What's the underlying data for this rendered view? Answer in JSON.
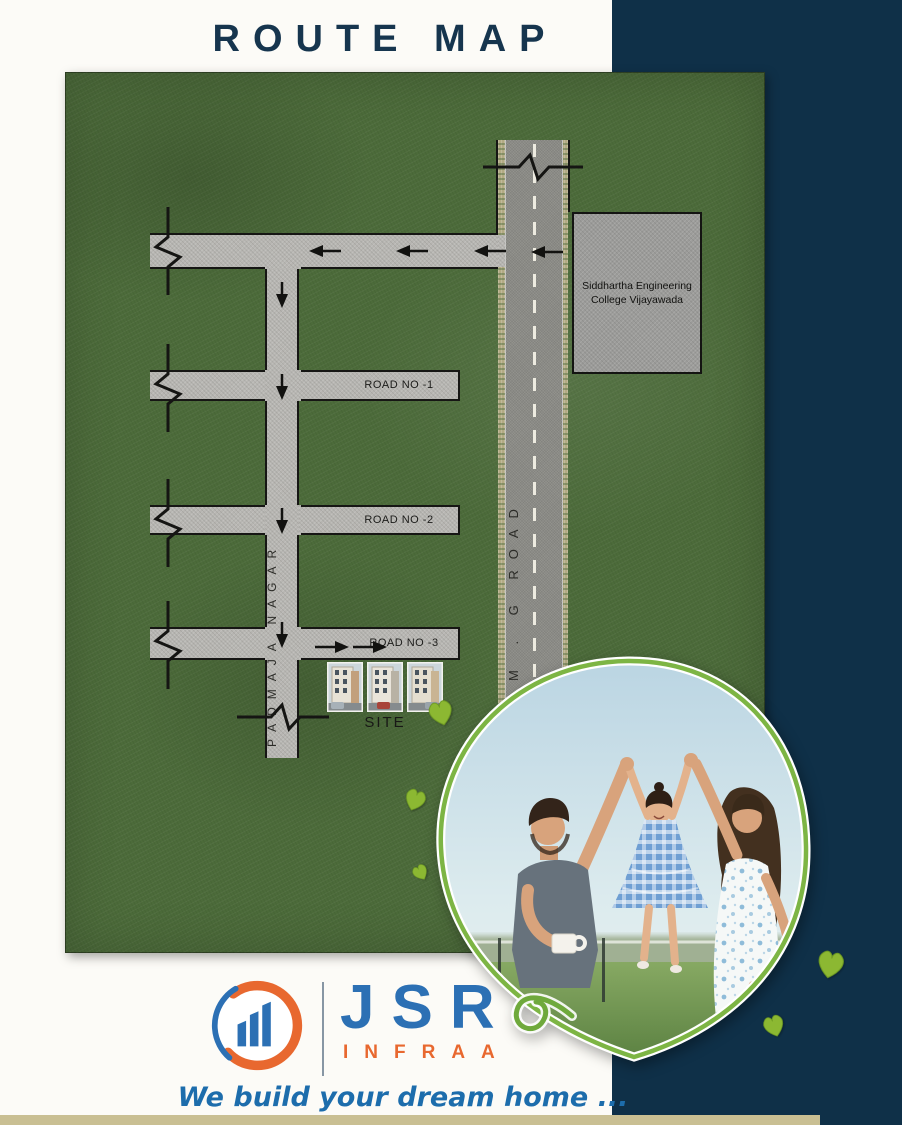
{
  "page": {
    "title": "ROUTE MAP"
  },
  "map": {
    "college_line1": "Siddhartha Engineering",
    "college_line2": "College Vijayawada",
    "mg_road_label": "M . G ROAD",
    "padmaja_label": "PADMAJA NAGAR",
    "road_no_1": "ROAD NO -1",
    "road_no_2": "ROAD NO -2",
    "road_no_3": "ROAD NO -3",
    "site_label": "SITE"
  },
  "branding": {
    "company_name": "JSR",
    "company_subname": "INFRAA",
    "tagline": "We build your dream home ...",
    "colors": {
      "logo_blue": "#2c70b4",
      "logo_orange": "#e8682f",
      "navy_panel": "#0f3048",
      "map_green": "#4c6b3a",
      "leaf_green": "#7db544",
      "tagline_blue": "#1d6dac"
    }
  }
}
